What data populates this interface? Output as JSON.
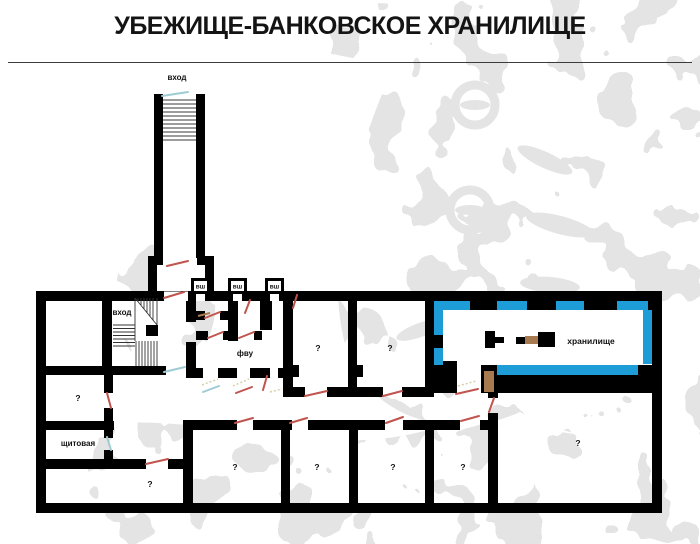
{
  "title": "УБЕЖИЩЕ-БАНКОВСКОЕ ХРАНИЛИЩЕ",
  "plan": {
    "entrance_top_label": "вход",
    "entrance_hall_label": "вход",
    "vent_shaft_labels": [
      "вш",
      "вш",
      "вш"
    ],
    "fvu_label": "фву",
    "vault_label": "хранилище",
    "switchboard_label": "щитовая",
    "unknown_room_label": "?"
  },
  "colors": {
    "wall": "#000000",
    "vault_lining": "#1e9cd8",
    "door_marker": "#c0544e",
    "door_marker_alt": "#9fccd4",
    "door_swing": "#d8cfa8",
    "vault_door": "#a87a50",
    "watermark": "#e4e4e4"
  }
}
